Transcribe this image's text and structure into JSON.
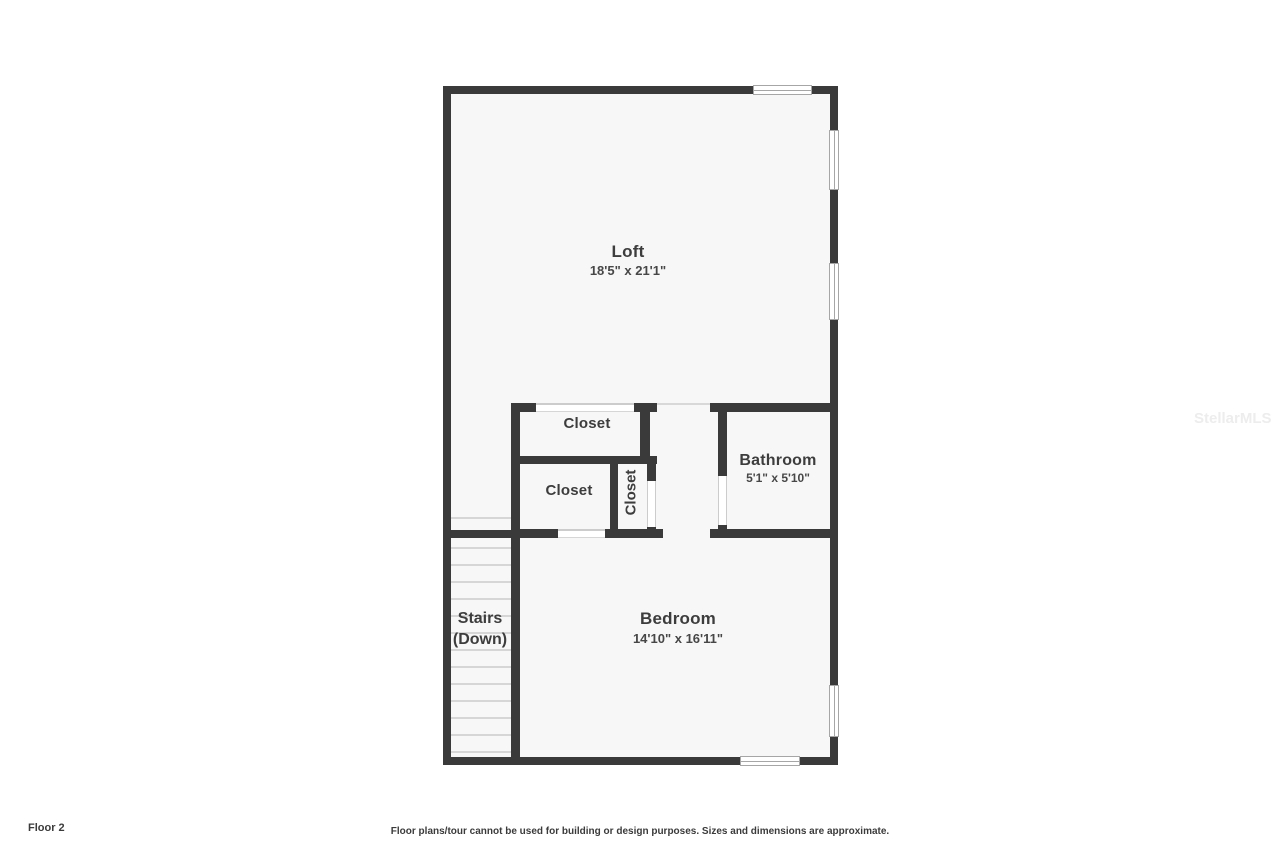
{
  "page": {
    "floor_label": "Floor 2",
    "disclaimer": "Floor plans/tour cannot be used for building or design purposes. Sizes and dimensions are approximate.",
    "watermark": "StellarMLS"
  },
  "rooms": {
    "loft": {
      "name": "Loft",
      "dims": "18'5\" x 21'1\""
    },
    "closet_top": {
      "name": "Closet"
    },
    "closet_lower": {
      "name": "Closet"
    },
    "closet_vertical": {
      "name": "Closet"
    },
    "bathroom": {
      "name": "Bathroom",
      "dims": "5'1\" x 5'10\""
    },
    "bedroom": {
      "name": "Bedroom",
      "dims": "14'10\" x 16'11\""
    },
    "stairs": {
      "line1": "Stairs",
      "line2": "(Down)"
    }
  },
  "colors": {
    "wall": "#3a3a3a",
    "floor": "#f7f7f7",
    "label_text": "#3d3d3d",
    "background": "#ffffff"
  }
}
